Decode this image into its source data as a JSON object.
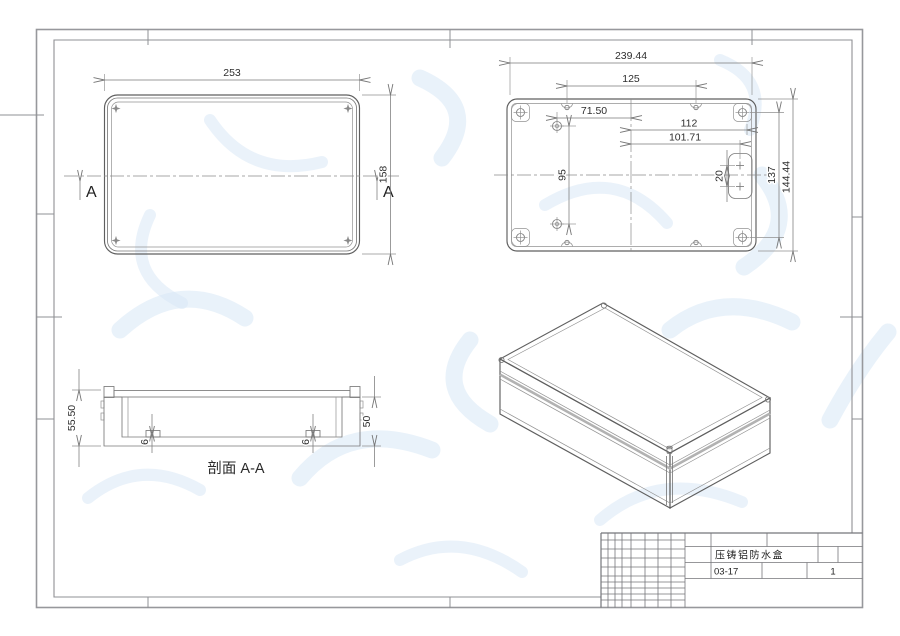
{
  "views": {
    "lid": {
      "width": "253",
      "height": "158",
      "marker": "A"
    },
    "base": {
      "overall_width": "239.44",
      "hole_span": "125",
      "boss_offset": "71.50",
      "wall_offset": "112",
      "tab_hole_offset": "101.71",
      "boss_span": "95",
      "tab_hole_span": "20",
      "screw_span": "137",
      "overall_height": "144.44"
    },
    "section": {
      "label": "剖面 A-A",
      "outer_height": "55.50",
      "inner_height": "50",
      "left_boss_height": "6",
      "right_boss_height": "6"
    }
  },
  "title_block": {
    "part_name": "压铸铝防水盒",
    "drawing_no": "03-17",
    "sheet_no": "1"
  },
  "colors": {
    "watermark": "#dfeaf6",
    "line": "#6a6a6a",
    "seam": "#b2b2b2"
  }
}
